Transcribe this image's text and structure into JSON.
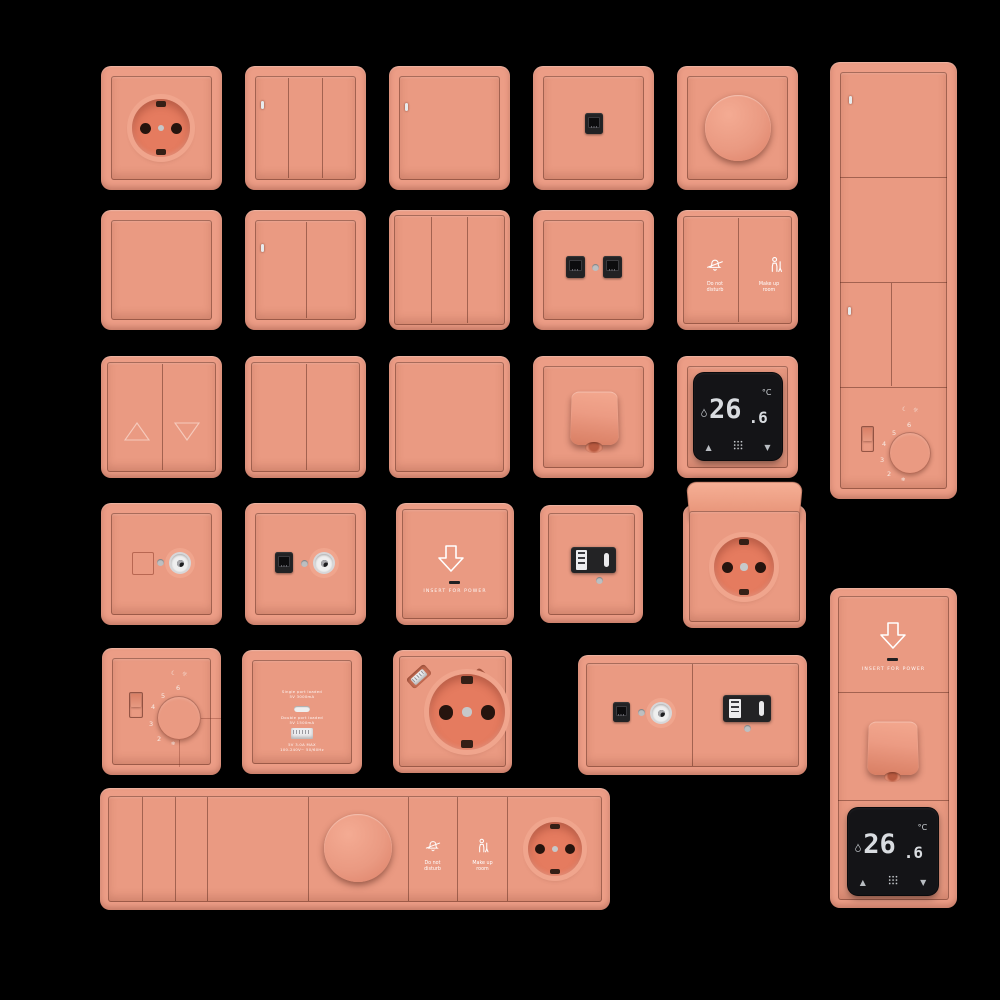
{
  "canvas": {
    "background": "#000000"
  },
  "colors": {
    "background": "#000000",
    "plate": "#EC9D86",
    "face": "#EA9A82",
    "cup": "#E57B5F",
    "bezel": "#F0A58D",
    "module": "#232325",
    "display_bg": "#141417",
    "display_text": "#D9DCE0"
  },
  "icons": {
    "up_triangle": "▲",
    "down_triangle": "▼",
    "moon": "☾",
    "sun": "☼",
    "snowflake": "❄"
  },
  "labels": {
    "dnd": {
      "line1": "Do not",
      "line2": "disturb"
    },
    "mur": {
      "line1": "Make up",
      "line2": "room"
    },
    "keycard": {
      "label": "INSERT FOR POWER"
    },
    "thermostat": {
      "value": "26.6",
      "value_int": "26",
      "value_frac": ".6",
      "unit": "°C"
    },
    "dial": {
      "n2": "2",
      "n3": "3",
      "n4": "4",
      "n5": "5",
      "n6": "6"
    },
    "usb_charger": {
      "l1": "Single port loaded",
      "l2": "5V 3000mA",
      "l3": "Double port loaded",
      "l4": "5V 1500mA",
      "l5": "5V 3.0A MAX",
      "l6": "100-240V~ 50/60Hz"
    }
  }
}
